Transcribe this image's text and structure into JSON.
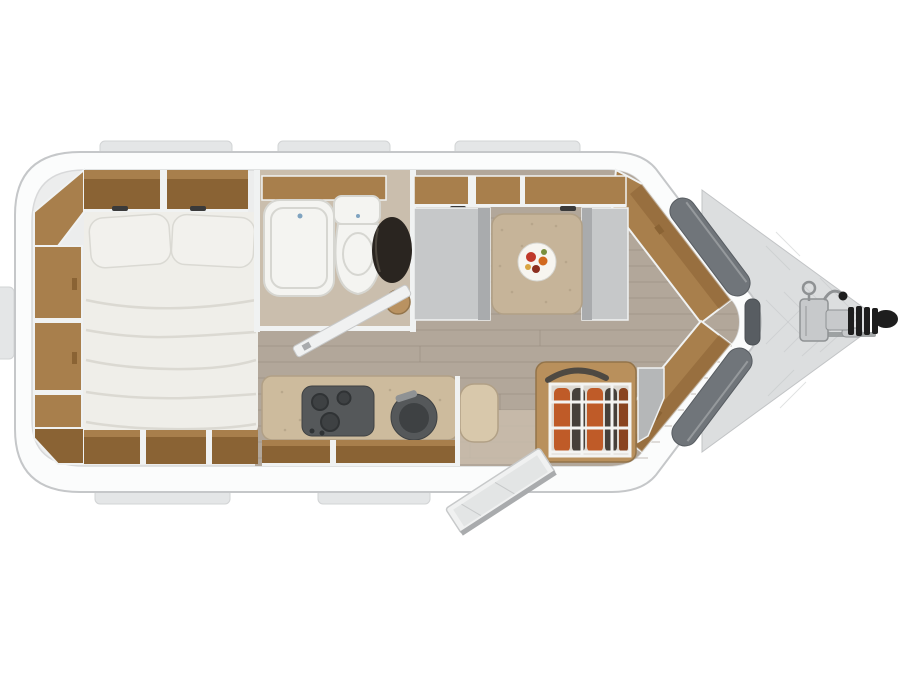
{
  "image": {
    "width": 900,
    "height": 675,
    "description": "Top-down 3D rendered floor plan of a single-axle caravan on a white background, hitch pointing right"
  },
  "colors": {
    "page_bg": "#ffffff",
    "shell": "#fbfcfc",
    "shell_outline": "#c5c7c9",
    "inner_trim": "#d8d9da",
    "inner_base": "#eceded",
    "trim_white": "#f0f2f2",
    "tab": "#e4e6e7",
    "tab_edge": "#d2d4d5",
    "wood": "#a87f4c",
    "wood_dark": "#8a6334",
    "wood_light": "#b99261",
    "wood_edge": "#93744a",
    "floor": "#b2a79a",
    "floor_line": "#978b7e",
    "bath_floor": "#cabead",
    "bed": "#efeee9",
    "bed_fold": "#d8d6cf",
    "pillow": "#f2f1ed",
    "pillow_edge": "#dad9d3",
    "fixture": "#f4f4f1",
    "fixture_edge": "#d6d6d1",
    "basin_dark": "#2a2520",
    "bench": "#c6c8c9",
    "bench_dark": "#a9abad",
    "table": "#c6b499",
    "table_edge": "#b1a086",
    "plate": "#f7f5f0",
    "counter": "#cdbb9d",
    "counter_light": "#d8c8ab",
    "hob": "#55585a",
    "hob_dark": "#3e4143",
    "fridge_wood": "#b9905c",
    "bottle_orange": "#bf5b28",
    "bottle_orange2": "#8a4420",
    "bottle_dark": "#46403a",
    "wire": "#f4f4f2",
    "gray_panel": "#b5b7b8",
    "nose_panel": "#70757a",
    "nose_tip": "#585d62",
    "plate_metal": "#dcdedf",
    "plate_metal_edge": "#c2c4c6",
    "hitch_metal": "#c7c9cb",
    "hitch_dark": "#8f9294",
    "handle_black": "#1e1e1e",
    "door": "#f0f1f1",
    "door_edge": "#c7c9ca",
    "light_fixture": "#3a3a3a",
    "fruit_red": "#c0392b",
    "fruit_red_dark": "#8c2f1f",
    "fruit_orange": "#d2691e",
    "fruit_green": "#7a8f3c",
    "fruit_yellow": "#d9a441",
    "drain_blue": "#7fa3c0"
  },
  "floorplan": {
    "zones": [
      {
        "id": "bedroom-rear-left",
        "features": [
          "double-bed",
          "two-pillows",
          "side-wardrobe-column",
          "overhead-shelves",
          "foot-of-bed-shelves"
        ]
      },
      {
        "id": "washroom-mid-top",
        "features": [
          "shower-tray",
          "toilet",
          "dark-washbasin",
          "open-washroom-door"
        ]
      },
      {
        "id": "kitchen-mid-bottom",
        "features": [
          "hob-with-burners",
          "round-sink",
          "worktop",
          "drawer-fronts"
        ]
      },
      {
        "id": "dinette-front-top",
        "features": [
          "bench-left",
          "bench-right",
          "table",
          "fruit-plate",
          "overhead-lockers",
          "reading-lights"
        ]
      },
      {
        "id": "entrance-front-bottom",
        "features": [
          "open-entry-door",
          "fridge-with-bottle-rack"
        ]
      },
      {
        "id": "nose-front",
        "features": [
          "angled-shelving",
          "dark-exterior-panels",
          "diamond-plate-drawbar-cover",
          "hitch-coupling",
          "jockey-wheel-handle",
          "black-hitch-grip"
        ]
      }
    ]
  }
}
